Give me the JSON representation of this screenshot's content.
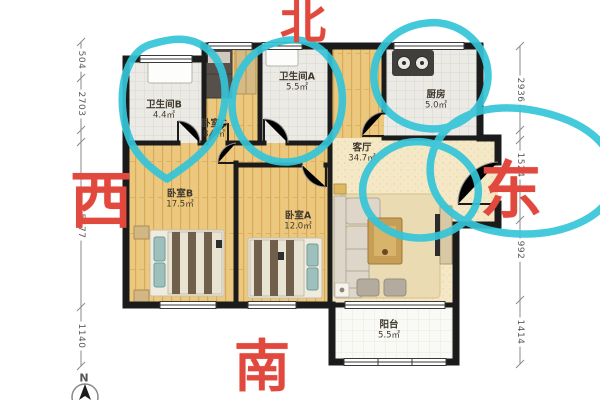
{
  "plan": {
    "rooms": [
      {
        "id": "bathroom-b",
        "name": "卫生间B",
        "area": "4.4㎡"
      },
      {
        "id": "bedroom-c",
        "name": "卧室C",
        "area": "8.3㎡"
      },
      {
        "id": "bathroom-a",
        "name": "卫生间A",
        "area": "5.5㎡"
      },
      {
        "id": "kitchen",
        "name": "厨房",
        "area": "5.0㎡"
      },
      {
        "id": "living-room",
        "name": "客厅",
        "area": "34.7㎡"
      },
      {
        "id": "bedroom-b",
        "name": "卧室B",
        "area": "17.5㎡"
      },
      {
        "id": "bedroom-a",
        "name": "卧室A",
        "area": "12.0㎡"
      },
      {
        "id": "balcony",
        "name": "阳台",
        "area": "5.5㎡"
      }
    ],
    "dimensions_left": [
      "504",
      "2703",
      "5577",
      "1140"
    ],
    "dimensions_right": [
      "2936",
      "1524",
      "992",
      "1414"
    ],
    "directions": {
      "north": "北",
      "south": "南",
      "west": "西",
      "east": "东"
    },
    "compass_label": "N",
    "colors": {
      "annotation_cyan": "#35c5d8",
      "direction_red": "#e1493f",
      "wall_black": "#1b1b1b"
    }
  }
}
